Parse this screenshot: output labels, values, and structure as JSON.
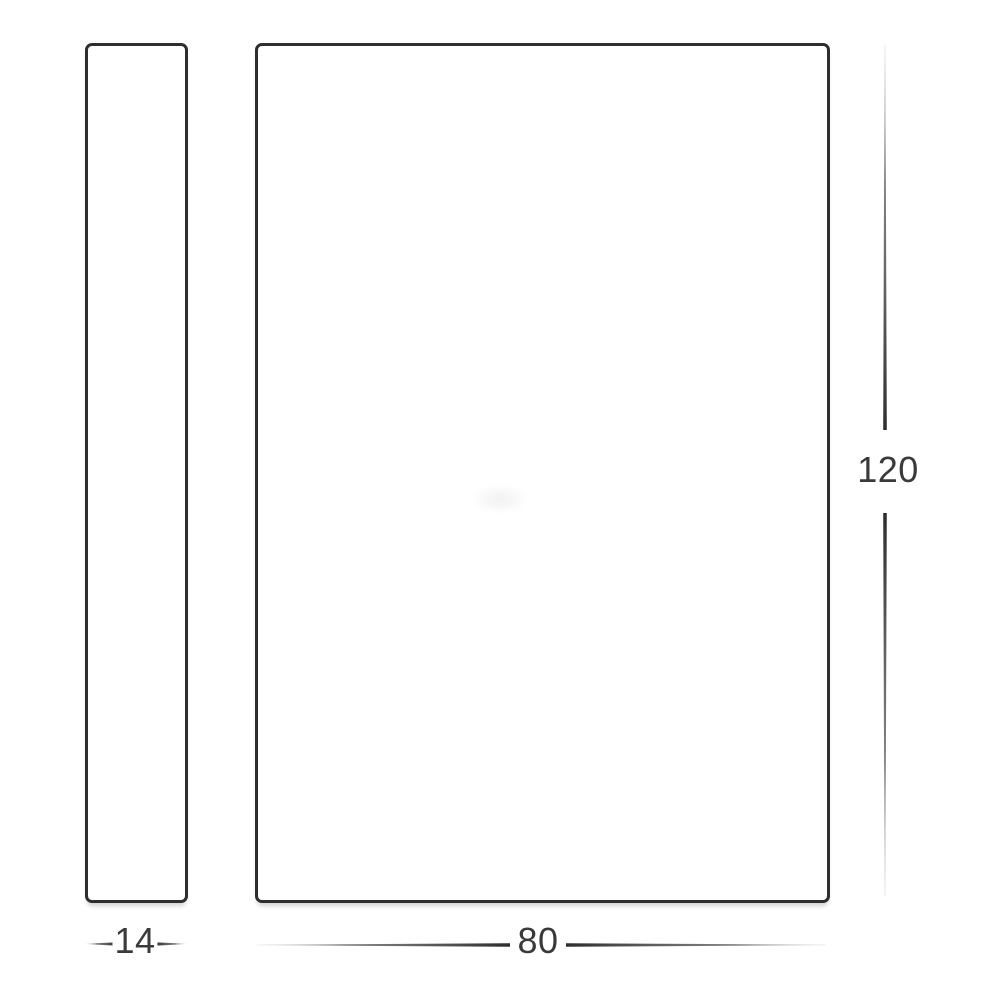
{
  "diagram": {
    "type": "technical-dimension-drawing",
    "colors": {
      "outline": "#2e2e2e",
      "dimension_line_dark": "#2e2e2e",
      "dimension_line_faded": "#b5b5b5",
      "label_text": "#3a3a3a",
      "background": "#ffffff"
    },
    "views": [
      {
        "name": "side-profile",
        "description_label": ""
      },
      {
        "name": "front-face",
        "description_label": ""
      }
    ],
    "dimensions": {
      "side_width": "14",
      "front_width": "80",
      "front_height": "120"
    }
  }
}
